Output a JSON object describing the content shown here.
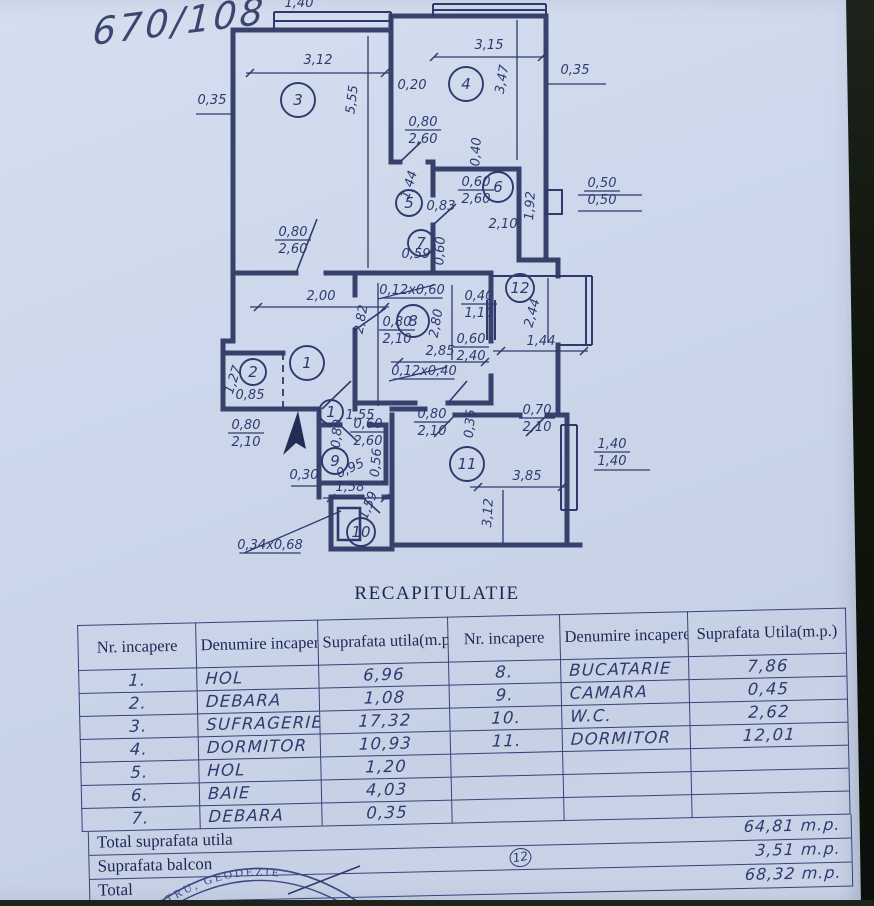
{
  "photo": {
    "annotation": "670/108"
  },
  "colors": {
    "paper": "#ccd7ea",
    "ink": "#2e3a6e",
    "wall": "#29355f",
    "background": "#10150d"
  },
  "plan": {
    "rooms": [
      {
        "n": "3",
        "x": 298,
        "y": 100,
        "rad": 17
      },
      {
        "n": "4",
        "x": 466,
        "y": 84,
        "rad": 17
      },
      {
        "n": "5",
        "x": 409,
        "y": 203,
        "rad": 13
      },
      {
        "n": "6",
        "x": 498,
        "y": 187,
        "rad": 15
      },
      {
        "n": "7",
        "x": 421,
        "y": 243,
        "rad": 13
      },
      {
        "n": "12",
        "x": 520,
        "y": 288,
        "rad": 14
      },
      {
        "n": "8",
        "x": 413,
        "y": 321,
        "rad": 16
      },
      {
        "n": "1",
        "x": 307,
        "y": 363,
        "rad": 17
      },
      {
        "n": "2",
        "x": 253,
        "y": 372,
        "rad": 13
      },
      {
        "n": "1",
        "x": 331,
        "y": 412,
        "rad": 12
      },
      {
        "n": "9",
        "x": 335,
        "y": 461,
        "rad": 13
      },
      {
        "n": "11",
        "x": 467,
        "y": 464,
        "rad": 17
      },
      {
        "n": "10",
        "x": 361,
        "y": 532,
        "rad": 14
      }
    ],
    "labels": [
      {
        "t": "1,40",
        "x": 299,
        "y": 7
      },
      {
        "t": "3,12",
        "x": 318,
        "y": 64
      },
      {
        "t": "5,55",
        "x": 356,
        "y": 100,
        "r": -83
      },
      {
        "t": "0,35",
        "x": 212,
        "y": 104
      },
      {
        "t": "3,15",
        "x": 489,
        "y": 49
      },
      {
        "t": "3,47",
        "x": 506,
        "y": 80,
        "r": -80
      },
      {
        "t": "0,35",
        "x": 575,
        "y": 74
      },
      {
        "t": "0,20",
        "x": 412,
        "y": 89
      },
      {
        "t": "0,80",
        "b": "2,60",
        "x": 423,
        "y": 126
      },
      {
        "t": "0,40",
        "x": 480,
        "y": 152,
        "r": -87
      },
      {
        "t": "1,44",
        "x": 413,
        "y": 186,
        "r": -73
      },
      {
        "t": "0,83",
        "x": 441,
        "y": 210
      },
      {
        "t": "0,60",
        "b": "2,60",
        "x": 476,
        "y": 186
      },
      {
        "t": "2,10",
        "x": 503,
        "y": 228
      },
      {
        "t": "1,92",
        "x": 534,
        "y": 206,
        "r": -86
      },
      {
        "t": "0,50",
        "b": "0,50",
        "x": 602,
        "y": 187
      },
      {
        "t": "0,80",
        "b": "2,60",
        "x": 293,
        "y": 236
      },
      {
        "t": "0,59",
        "x": 416,
        "y": 258
      },
      {
        "t": "0,60",
        "x": 444,
        "y": 251,
        "r": -87
      },
      {
        "t": "2,00",
        "x": 321,
        "y": 300
      },
      {
        "t": "2,82",
        "x": 365,
        "y": 320,
        "r": -80
      },
      {
        "t": "0,12x0,60",
        "x": 412,
        "y": 294,
        "u": 1
      },
      {
        "t": "0,40",
        "b": "1,10",
        "x": 479,
        "y": 300
      },
      {
        "t": "0,80",
        "b": "2,10",
        "x": 397,
        "y": 326
      },
      {
        "t": "2,80",
        "x": 440,
        "y": 324,
        "r": -80
      },
      {
        "t": "2,85",
        "x": 440,
        "y": 355
      },
      {
        "t": "0,60",
        "b": "2,40",
        "x": 471,
        "y": 343
      },
      {
        "t": "2,44",
        "x": 536,
        "y": 314,
        "r": -75
      },
      {
        "t": "1,44",
        "x": 541,
        "y": 345
      },
      {
        "t": "1,27",
        "x": 237,
        "y": 381,
        "r": -72
      },
      {
        "t": "0,85",
        "x": 250,
        "y": 399
      },
      {
        "t": "0,12x0,40",
        "x": 424,
        "y": 375,
        "u": 1
      },
      {
        "t": "0,80",
        "b": "2,10",
        "x": 246,
        "y": 429
      },
      {
        "t": "1,55",
        "x": 360,
        "y": 419
      },
      {
        "t": "0,80",
        "x": 341,
        "y": 434,
        "r": -85
      },
      {
        "t": "0,60",
        "b": "2,60",
        "x": 368,
        "y": 428
      },
      {
        "t": "0,95",
        "x": 352,
        "y": 472,
        "r": -25
      },
      {
        "t": "0,56",
        "x": 380,
        "y": 463,
        "r": -85
      },
      {
        "t": "0,80",
        "b": "2,10",
        "x": 432,
        "y": 418
      },
      {
        "t": "0,35",
        "x": 474,
        "y": 424,
        "r": -85
      },
      {
        "t": "0,70",
        "b": "2,10",
        "x": 537,
        "y": 414
      },
      {
        "t": "3,85",
        "x": 527,
        "y": 480
      },
      {
        "t": "3,12",
        "x": 492,
        "y": 513,
        "r": -86
      },
      {
        "t": "1,40",
        "b": "1,40",
        "x": 612,
        "y": 448
      },
      {
        "t": "0,30",
        "x": 304,
        "y": 479
      },
      {
        "t": "1,58",
        "x": 350,
        "y": 491
      },
      {
        "t": "1,59",
        "x": 372,
        "y": 507,
        "r": -68
      },
      {
        "t": "0,34x0,68",
        "x": 270,
        "y": 549,
        "u": 1
      }
    ]
  },
  "recap": {
    "title": "RECAPITULATIE",
    "header": {
      "col_nr": "Nr. incapere",
      "col_name": "Denumire incapere",
      "col_area_left": "Suprafata utila(m.p.)",
      "col_nr2": "Nr. incapere",
      "col_name2": "Denumire incapere",
      "col_area_right": "Suprafata Utila(m.p.)"
    },
    "rows": [
      {
        "nr": "1.",
        "name": "HOL",
        "area": "6,96",
        "nr2": "8.",
        "name2": "BUCATARIE",
        "area2": "7,86"
      },
      {
        "nr": "2.",
        "name": "DEBARA",
        "area": "1,08",
        "nr2": "9.",
        "name2": "CAMARA",
        "area2": "0,45"
      },
      {
        "nr": "3.",
        "name": "SUFRAGERIE",
        "area": "17,32",
        "nr2": "10.",
        "name2": "W.C.",
        "area2": "2,62"
      },
      {
        "nr": "4.",
        "name": "DORMITOR",
        "area": "10,93",
        "nr2": "11.",
        "name2": "DORMITOR",
        "area2": "12,01"
      },
      {
        "nr": "5.",
        "name": "HOL",
        "area": "1,20",
        "nr2": "",
        "name2": "",
        "area2": ""
      },
      {
        "nr": "6.",
        "name": "BAIE",
        "area": "4,03",
        "nr2": "",
        "name2": "",
        "area2": ""
      },
      {
        "nr": "7.",
        "name": "DEBARA",
        "area": "0,35",
        "nr2": "",
        "name2": "",
        "area2": ""
      }
    ],
    "totals": [
      {
        "label": "Total suprafata utila",
        "badge": "",
        "value": "64,81 m.p."
      },
      {
        "label": "Suprafata balcon",
        "badge": "12",
        "value": "3,51 m.p."
      },
      {
        "label": "Total",
        "badge": "",
        "value": "68,32 m.p."
      }
    ]
  },
  "stamp": {
    "arc_text": "TRU, GEODEZIE"
  }
}
